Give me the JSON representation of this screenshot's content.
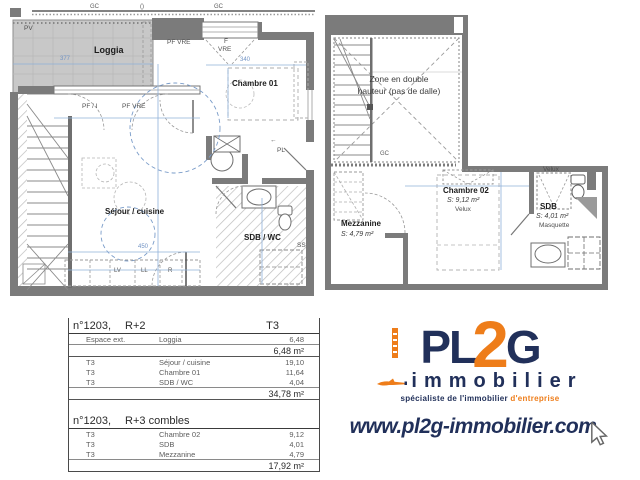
{
  "plans": {
    "r2": {
      "labels": {
        "gc_left": "GC",
        "vent": "()",
        "gc_right": "GC",
        "pv": "PV",
        "loggia": "Loggia",
        "pf_vre_top": "PF VRE",
        "f": "F",
        "vre": "VRE",
        "chambre01": "Chambre 01",
        "pf_i": "PF / I",
        "pf_vre_mid": "PF VRE",
        "sejour": "Séjour / cuisine",
        "entry_arrow": "←",
        "pl": "PL",
        "sdb_wc": "SDB / WC",
        "ss": "SS",
        "lv": "LV",
        "ll": "LL",
        "r": "R"
      },
      "dims": {
        "loggia_w": "377",
        "chambre_w": "340",
        "kitchen_w": "450"
      }
    },
    "r3": {
      "labels": {
        "zone": "Zone en double hauteur (pas de dalle)",
        "gc": "GC",
        "mezzanine": "Mezzanine",
        "mezzanine_area": "S: 4,79 m²",
        "chambre02": "Chambre 02",
        "chambre02_area": "S: 9,12 m²",
        "velux_chambre": "Velux",
        "velux_sdb": "Velux",
        "sdb": "SDB",
        "sdb_area": "S: 4,01 m²",
        "masquette": "Masquette"
      }
    }
  },
  "table": {
    "section1": {
      "unit": "n°1203,",
      "level": "R+2",
      "type": "T3",
      "ext": {
        "rows": [
          [
            "Espace ext.",
            "Loggia",
            "6,48"
          ]
        ],
        "subtotal": "6,48 m²"
      },
      "main": {
        "rows": [
          [
            "T3",
            "Séjour / cuisine",
            "19,10"
          ],
          [
            "T3",
            "Chambre 01",
            "11,64"
          ],
          [
            "T3",
            "SDB / WC",
            "4,04"
          ]
        ],
        "subtotal": "34,78 m²"
      }
    },
    "section2": {
      "unit": "n°1203,",
      "level": "R+3 combles",
      "main": {
        "rows": [
          [
            "T3",
            "Chambre 02",
            "9,12"
          ],
          [
            "T3",
            "SDB",
            "4,01"
          ],
          [
            "T3",
            "Mezzanine",
            "4,79"
          ]
        ],
        "subtotal": "17,92 m²"
      }
    }
  },
  "logo": {
    "part_pl": "PL",
    "part_2": "2",
    "part_g": "G",
    "word": "immobilier",
    "tagline": "spécialiste de l'immobilier",
    "tagline_accent": "d'entreprise",
    "website": "www.pl2g-immobilier.com"
  },
  "colors": {
    "navy": "#21305a",
    "orange": "#ee7d1a",
    "wall_gray": "#7b7b7b",
    "loggia_fill": "#c8c8c8",
    "dim_blue": "#8fb0d9"
  }
}
